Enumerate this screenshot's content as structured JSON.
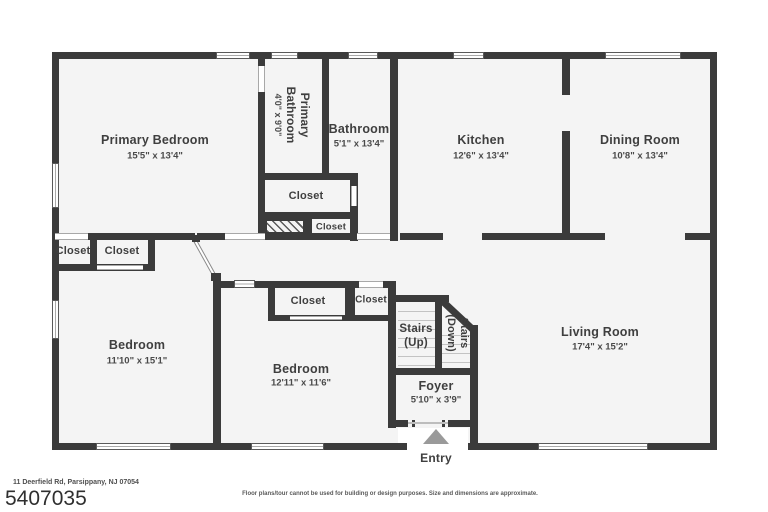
{
  "plan": {
    "closet_label": "Closet",
    "rooms": {
      "primary_bedroom": {
        "name": "Primary Bedroom",
        "dims": "15'5\" x 13'4\""
      },
      "primary_bathroom": {
        "line1": "Primary",
        "line2": "Bathroom",
        "dims": "4'0\" x 9'0\""
      },
      "bathroom": {
        "name": "Bathroom",
        "dims": "5'1\" x 13'4\""
      },
      "kitchen": {
        "name": "Kitchen",
        "dims": "12'6\" x 13'4\""
      },
      "dining_room": {
        "name": "Dining Room",
        "dims": "10'8\" x 13'4\""
      },
      "bedroom_left": {
        "name": "Bedroom",
        "dims": "11'10\" x 15'1\""
      },
      "bedroom_middle": {
        "name": "Bedroom",
        "dims": "12'11\" x 11'6\""
      },
      "living_room": {
        "name": "Living Room",
        "dims": "17'4\" x 15'2\""
      },
      "foyer": {
        "name": "Foyer",
        "dims": "5'10\" x 3'9\""
      }
    },
    "stairs": {
      "up_line1": "Stairs",
      "up_line2": "(Up)",
      "down_line1": "Stairs",
      "down_line2": "(Down)"
    },
    "entry_label": "Entry",
    "colors": {
      "wall": "#3b3b3b",
      "floor": "#f4f4f4",
      "entry_arrow": "#9a9a9a"
    }
  },
  "footer": {
    "address": "11 Deerfield Rd, Parsippany, NJ 07054",
    "mls_number": "5407035",
    "disclaimer": "Floor plans/tour cannot be used for building or design purposes. Size and dimensions are approximate."
  }
}
